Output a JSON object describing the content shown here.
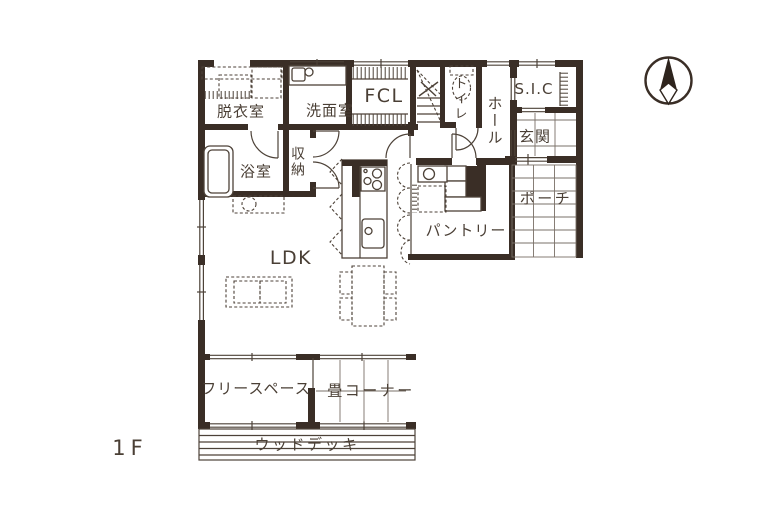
{
  "floor_label": "1F",
  "compass": {
    "icon": "north-needle"
  },
  "labels": {
    "dressing_room": "脱衣室",
    "washroom": "洗面室",
    "family_closet": "FCL",
    "toilet": "トイレ",
    "hall": "ホール",
    "shoe_in_closet": "S.I.C",
    "entrance": "玄関",
    "porch": "ポーチ",
    "pantry": "パントリー",
    "bathroom": "浴室",
    "storage": "収納",
    "ldk": "LDK",
    "free_space": "フリースペース",
    "tatami_corner": "畳コーナー",
    "wood_deck": "ウッドデッキ"
  },
  "colors": {
    "wall": "#3a2e26",
    "line": "#4d4238",
    "light": "#7a7068",
    "text": "#4a3f35",
    "background": "#ffffff"
  }
}
